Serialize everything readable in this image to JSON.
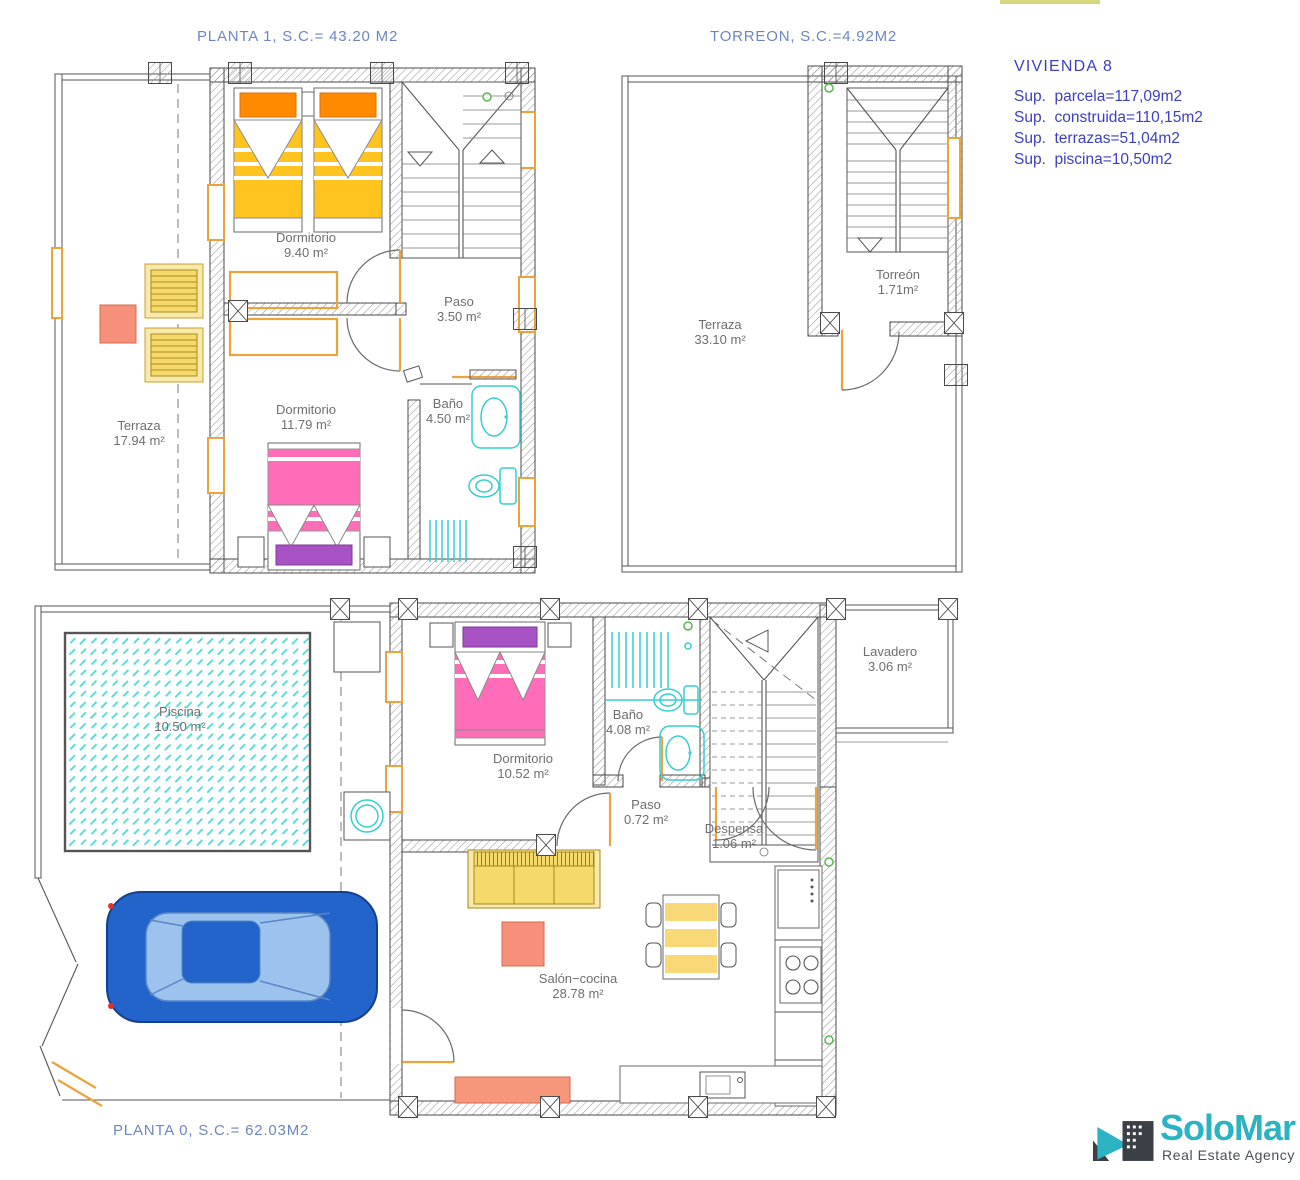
{
  "plans": {
    "planta1": {
      "title": "PLANTA 1, S.C.= 43.20 M2",
      "rooms": [
        {
          "name": "Dormitorio",
          "area": "9.40 m²"
        },
        {
          "name": "Paso",
          "area": "3.50 m²"
        },
        {
          "name": "Dormitorio",
          "area": "11.79 m²"
        },
        {
          "name": "Baño",
          "area": "4.50 m²"
        },
        {
          "name": "Terraza",
          "area": "17.94 m²"
        }
      ]
    },
    "torreon": {
      "title": "TORREON, S.C.=4.92M2",
      "rooms": [
        {
          "name": "Terraza",
          "area": "33.10 m²"
        },
        {
          "name": "Torreón",
          "area": "1.71m²"
        }
      ]
    },
    "planta0": {
      "title": "PLANTA 0, S.C.= 62.03M2",
      "rooms": [
        {
          "name": "Piscina",
          "area": "10.50 m²"
        },
        {
          "name": "Dormitorio",
          "area": "10.52 m²"
        },
        {
          "name": "Baño",
          "area": "4.08 m²"
        },
        {
          "name": "Paso",
          "area": "0.72 m²"
        },
        {
          "name": "Despensa",
          "area": "1.06 m²"
        },
        {
          "name": "Lavadero",
          "area": "3.06 m²"
        },
        {
          "name": "Salón−cocina",
          "area": "28.78 m²"
        }
      ]
    }
  },
  "info_panel": {
    "title": "VIVIENDA  8",
    "lines": [
      "Sup.  parcela=117,09m2",
      "Sup.  construida=110,15m2",
      "Sup.  terrazas=51,04m2",
      "Sup.  piscina=10,50m2"
    ]
  },
  "logo": {
    "name": "SoloMar",
    "tagline": "Real Estate Agency"
  },
  "colors": {
    "title_blue": "#6c87bf",
    "info_blue": "#3c3fc1",
    "label_gray": "#6e6e6e",
    "accent_orange": "#eda23b",
    "bed_yellow": "#ffc41e",
    "pillow_orange": "#ff8a00",
    "bed_pink": "#ff6cb8",
    "pillow_purple": "#a852c5",
    "fixture_cyan": "#35ced2",
    "pool_cyan": "#49dcd7",
    "car_blue": "#2264c9",
    "salmon": "#f6907a",
    "logo_teal": "#2cb3c3",
    "logo_dark": "#3b4046"
  }
}
